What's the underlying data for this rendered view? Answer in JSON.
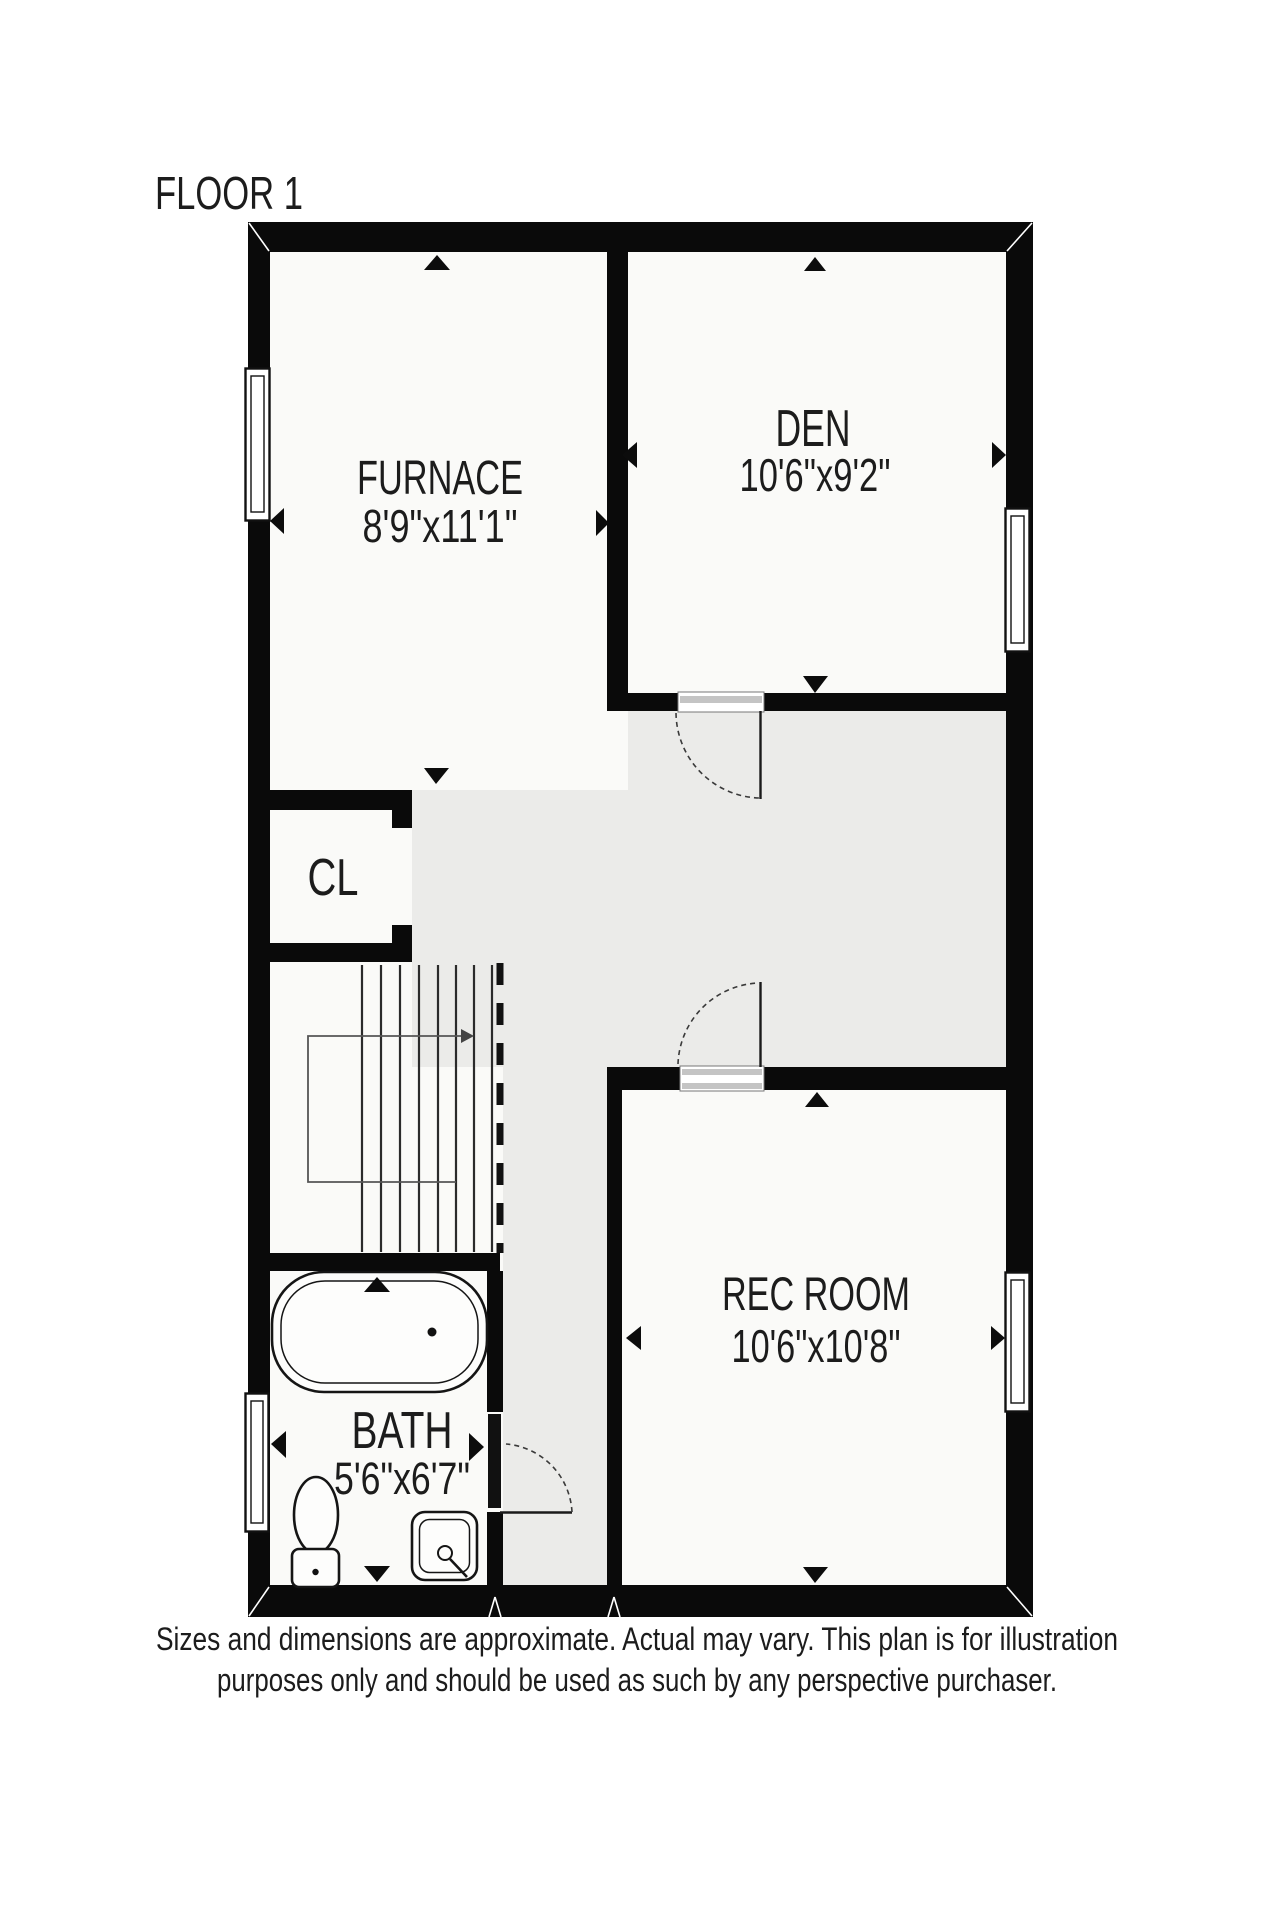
{
  "page": {
    "title": "FLOOR 1"
  },
  "rooms": [
    {
      "id": "furnace",
      "label": "FURNACE",
      "dimensions": "8'9\"x11'1\""
    },
    {
      "id": "den",
      "label": "DEN",
      "dimensions": "10'6\"x9'2\""
    },
    {
      "id": "closet",
      "label": "CL",
      "dimensions": ""
    },
    {
      "id": "rec-room",
      "label": "REC ROOM",
      "dimensions": "10'6\"x10'8\""
    },
    {
      "id": "bath",
      "label": "BATH",
      "dimensions": "5'6\"x6'7\""
    }
  ],
  "disclaimer": {
    "line1": "Sizes and dimensions are approximate. Actual may vary. This plan is for illustration",
    "line2": "purposes only and should be used as such by any perspective purchaser."
  },
  "features": {
    "doors": [
      "den-door",
      "rec-room-door",
      "bath-door"
    ],
    "windows": [
      "furnace-window-left",
      "den-window-right",
      "rec-room-window-right",
      "bath-window-left"
    ],
    "fixtures": [
      "staircase",
      "bathtub",
      "toilet",
      "sink"
    ]
  },
  "colors": {
    "wall": "#0a0a0a",
    "room_fill": "#fafaf8",
    "hall_fill": "#ebebe9",
    "background": "#ffffff",
    "text": "#1c1c1c"
  }
}
